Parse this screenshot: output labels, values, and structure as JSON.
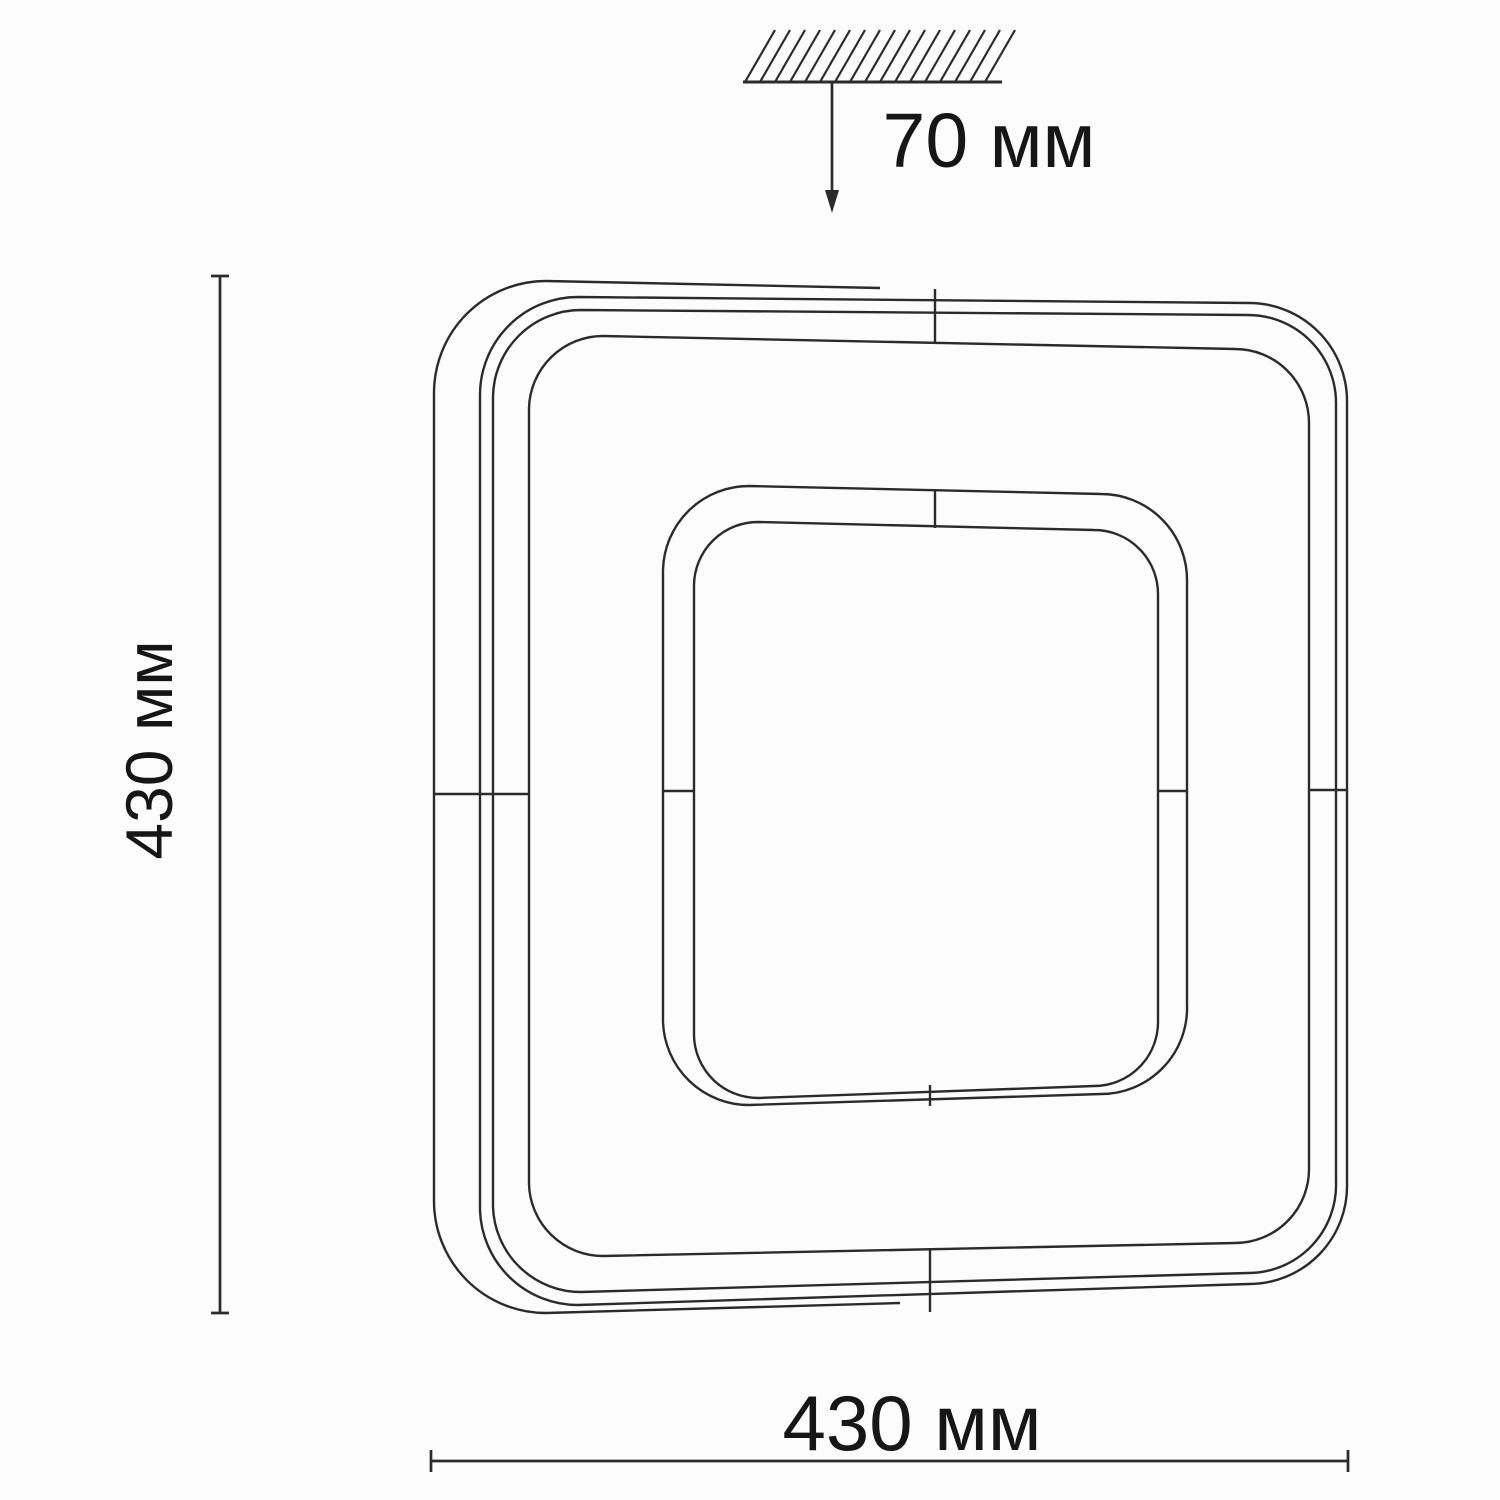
{
  "drawing": {
    "type": "technical-dimension-drawing",
    "subject": "square ceiling light fixture, front view with mounting depth",
    "labels": {
      "depth": "70 мм",
      "height": "430 мм",
      "width": "430 мм"
    }
  },
  "colors": {
    "line": "#2b2b2b",
    "text": "#161616",
    "background": "#fcfcfc"
  }
}
